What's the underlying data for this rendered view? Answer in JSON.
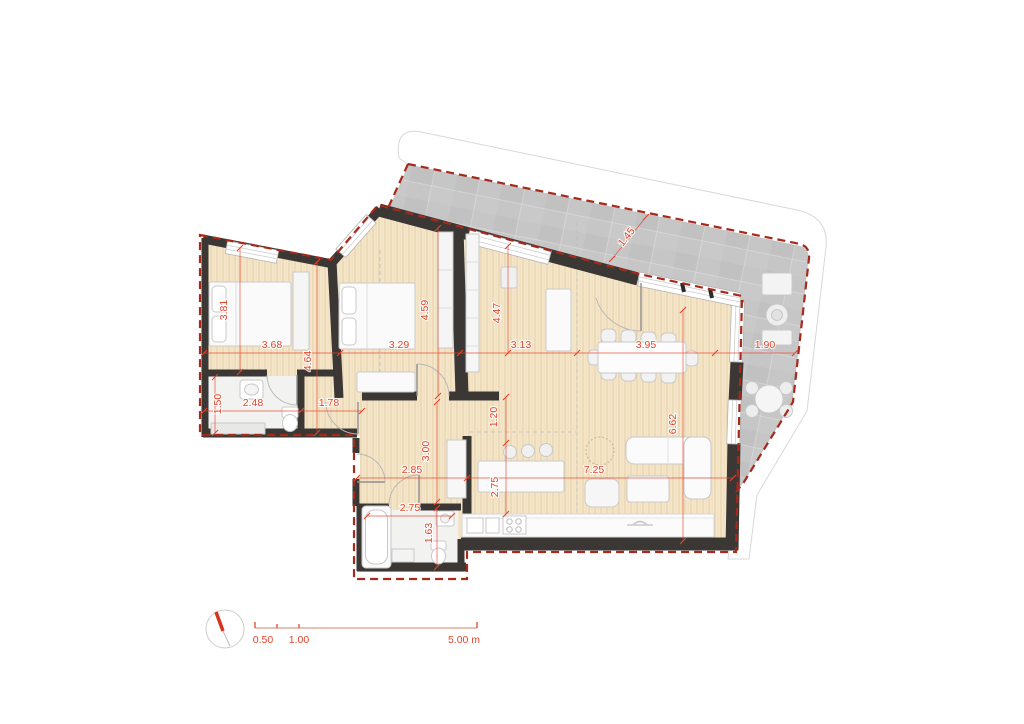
{
  "colors": {
    "dimension_red": "#e8432a",
    "boundary_red": "#a6291b",
    "wall_black": "#3a3734",
    "floor_wood": "#f5e6c9",
    "floor_wood_grain": "#ba8f54",
    "terrace_gray": "#c6c6c6",
    "slab_edge_gray": "#d8d8d8",
    "furniture_fill": "#f7f7f7",
    "furniture_stroke": "#c9c9c9",
    "bath_floor": "#f2f2f0"
  },
  "dimensions": [
    {
      "label": "3.81",
      "x": 227,
      "y": 310,
      "rotate": -90
    },
    {
      "label": "3.68",
      "x": 272,
      "y": 348,
      "rotate": 0
    },
    {
      "label": "4.64",
      "x": 311,
      "y": 361,
      "rotate": -90
    },
    {
      "label": "3.29",
      "x": 399,
      "y": 348,
      "rotate": 0
    },
    {
      "label": "4.59",
      "x": 428,
      "y": 310,
      "rotate": -90
    },
    {
      "label": "4.47",
      "x": 500,
      "y": 313,
      "rotate": -90
    },
    {
      "label": "3.13",
      "x": 521,
      "y": 348,
      "rotate": 0
    },
    {
      "label": "3.95",
      "x": 646,
      "y": 348,
      "rotate": 0
    },
    {
      "label": "1.45",
      "x": 629,
      "y": 239,
      "rotate": -52
    },
    {
      "label": "1.90",
      "x": 765,
      "y": 348,
      "rotate": 0
    },
    {
      "label": "1.50",
      "x": 221,
      "y": 404,
      "rotate": -90
    },
    {
      "label": "2.48",
      "x": 253,
      "y": 406,
      "rotate": 0
    },
    {
      "label": "1.78",
      "x": 329,
      "y": 406,
      "rotate": 0
    },
    {
      "label": "1.20",
      "x": 497,
      "y": 417,
      "rotate": -90
    },
    {
      "label": "3.00",
      "x": 429,
      "y": 451,
      "rotate": -90
    },
    {
      "label": "2.85",
      "x": 412,
      "y": 473,
      "rotate": 0
    },
    {
      "label": "2.75",
      "x": 498,
      "y": 487,
      "rotate": -90
    },
    {
      "label": "7.25",
      "x": 594,
      "y": 473,
      "rotate": 0
    },
    {
      "label": "6.62",
      "x": 676,
      "y": 424,
      "rotate": -90
    },
    {
      "label": "2.75",
      "x": 410,
      "y": 511,
      "rotate": 0
    },
    {
      "label": "1.63",
      "x": 432,
      "y": 533,
      "rotate": -90
    }
  ],
  "scale_bar": {
    "labels": [
      {
        "text": "0.50",
        "x": 263
      },
      {
        "text": "1.00",
        "x": 299
      },
      {
        "text": "5.00 m",
        "x": 464
      }
    ]
  }
}
